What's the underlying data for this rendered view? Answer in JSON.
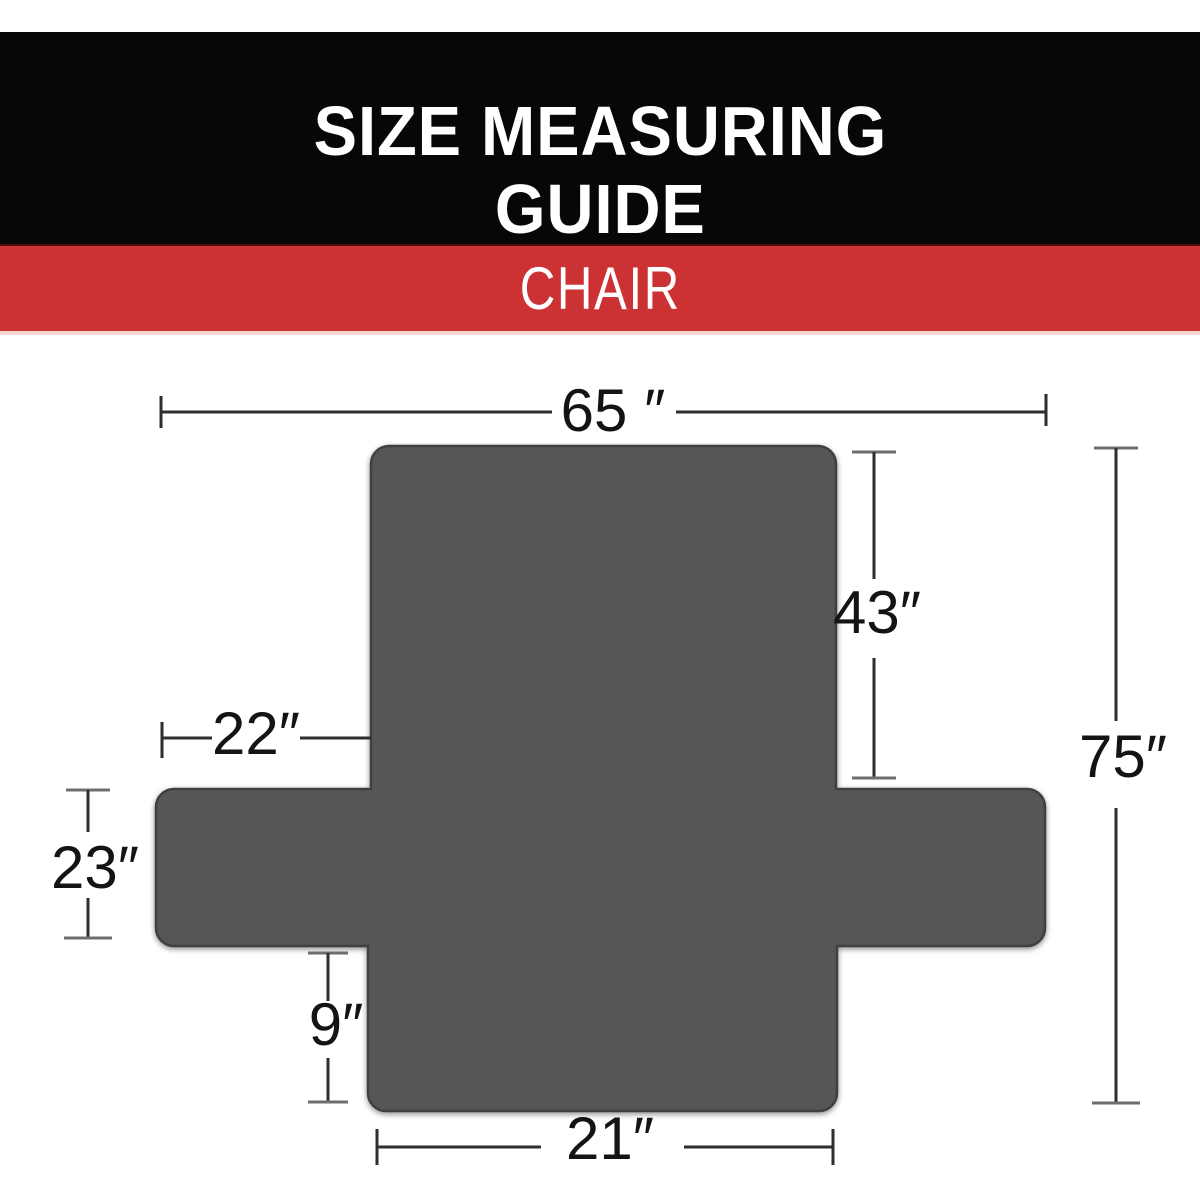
{
  "header": {
    "title_line1": "SIZE MEASURING",
    "title_line2": "GUIDE"
  },
  "banner": {
    "label": "CHAIR"
  },
  "colors": {
    "header_background": "#070707",
    "banner_red": "#cc3133",
    "cover_gray": "#575757",
    "dimension_line": "#2e2e2e",
    "label_text": "#141414"
  },
  "diagram": {
    "subject": "chair slipcover flat layout (cross shape)",
    "unit": "inches",
    "measurements": {
      "top_width": {
        "value": 65,
        "display": "65 ″"
      },
      "backrest_length": {
        "value": 43,
        "display": "43″"
      },
      "total_length": {
        "value": 75,
        "display": "75″"
      },
      "back_top_edge": {
        "value": 22,
        "display": "22″"
      },
      "arm_flap_width": {
        "value": 23,
        "display": "23″"
      },
      "front_drop": {
        "value": 9,
        "display": "9″"
      },
      "seat_width": {
        "value": 21,
        "display": "21″"
      }
    }
  }
}
